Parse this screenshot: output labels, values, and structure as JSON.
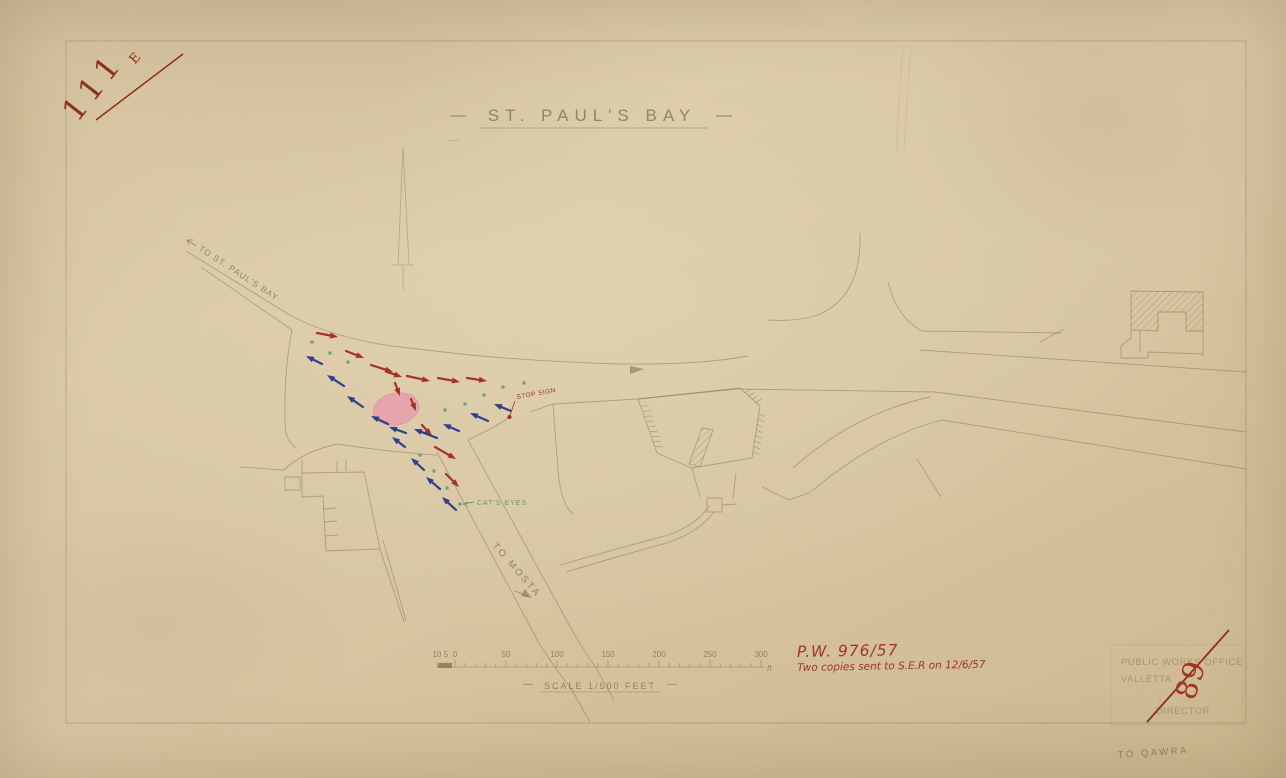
{
  "corner_marks": {
    "top_left_number": "111",
    "top_left_superscript": "E",
    "bottom_right_number": "89"
  },
  "title": {
    "dash": "—",
    "text": "ST. PAUL'S BAY"
  },
  "map_labels": {
    "to_st_pauls_bay": "TO ST. PAUL'S BAY",
    "to_qawra": "TO QAWRA",
    "to_mosta": "TO MOSTA",
    "stop_sign": "STOP SIGN",
    "cats_eyes": "CAT'S EYES"
  },
  "scale_bar": {
    "tick_labels": [
      "10",
      "5",
      "0",
      "50",
      "100",
      "150",
      "200",
      "250",
      "300"
    ],
    "unit": "ft",
    "dash": "—",
    "caption": "SCALE 1/500 FEET"
  },
  "annotations_red": {
    "reference": "P.W. 976/57",
    "note": "Two copies sent to S.E.R on 12/6/57"
  },
  "stamp": {
    "line1": "PUBLIC WORKS OFFICE",
    "line2": "VALLETTA",
    "line3": "DIRECTOR"
  },
  "colors": {
    "paper": "#d8c6a2",
    "pencil": "#83724f",
    "red_ink": "#a33322",
    "dark_red": "#8e2f1f",
    "blue_ink": "#2e3f8e",
    "green_ink": "#5f9e74",
    "island_pink": "#e8a4ad"
  },
  "map_data": {
    "island": {
      "cx": 396,
      "cy": 409,
      "rx": 23,
      "ry": 16,
      "rotate": -12
    },
    "red_arrows": [
      [
        317,
        333,
        338,
        337
      ],
      [
        346,
        351,
        364,
        358
      ],
      [
        371,
        365,
        393,
        372
      ],
      [
        387,
        372,
        402,
        377
      ],
      [
        407,
        376,
        430,
        381
      ],
      [
        438,
        378,
        460,
        382
      ],
      [
        467,
        378,
        487,
        381
      ],
      [
        395,
        383,
        400,
        396
      ],
      [
        411,
        399,
        416,
        411
      ],
      [
        422,
        425,
        432,
        436
      ],
      [
        435,
        447,
        456,
        459
      ],
      [
        446,
        474,
        459,
        487
      ]
    ],
    "blue_arrows": [
      [
        322,
        364,
        306,
        356
      ],
      [
        344,
        386,
        327,
        375
      ],
      [
        363,
        407,
        347,
        396
      ],
      [
        388,
        424,
        371,
        416
      ],
      [
        406,
        433,
        389,
        427
      ],
      [
        437,
        438,
        414,
        429
      ],
      [
        459,
        431,
        443,
        424
      ],
      [
        488,
        421,
        470,
        413
      ],
      [
        511,
        411,
        494,
        404
      ],
      [
        405,
        447,
        392,
        437
      ],
      [
        424,
        470,
        411,
        458
      ],
      [
        440,
        489,
        426,
        477
      ],
      [
        456,
        510,
        442,
        497
      ]
    ],
    "cats_eyes_dots": [
      [
        312,
        342
      ],
      [
        330,
        353
      ],
      [
        348,
        362
      ],
      [
        445,
        410
      ],
      [
        465,
        404
      ],
      [
        484,
        395
      ],
      [
        503,
        387
      ],
      [
        524,
        383
      ],
      [
        420,
        455
      ],
      [
        434,
        471
      ],
      [
        447,
        488
      ],
      [
        460,
        504
      ]
    ]
  }
}
